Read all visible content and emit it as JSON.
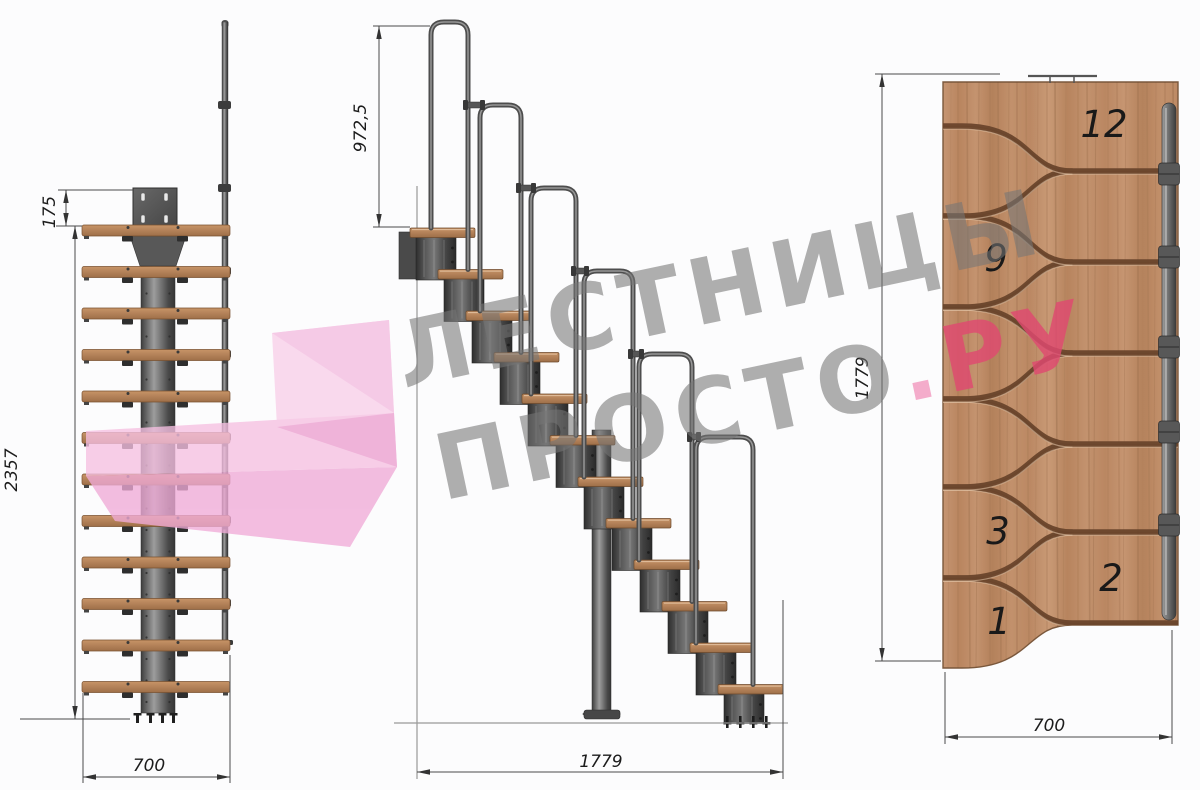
{
  "watermark": {
    "line1": "ЛЕСТНИЦЫ",
    "line2_word": "ПРОСТО",
    "line2_dot": ".",
    "line2_tld": "РУ"
  },
  "front_view": {
    "dim_top_offset": "175",
    "dim_total_height": "2357",
    "dim_width": "700"
  },
  "side_view": {
    "dim_handrail_height": "972,5",
    "dim_total_length": "1779"
  },
  "plan_view": {
    "dim_total_length": "1779",
    "dim_width": "700",
    "step_numbers": [
      "12",
      "9",
      "3",
      "2",
      "1"
    ]
  },
  "colors": {
    "watermark_gray": "#767676",
    "watermark_pink": "#df4970",
    "logo_pink_light": "#f8c9e6",
    "logo_pink_mid": "#f3b5dc",
    "logo_pink_dark": "#eb9fce",
    "wood_panel": "#c6946f",
    "tread_wood": "#b5845c",
    "metal_dark": "#3f3f3f",
    "metal_mid": "#6f6f6f"
  }
}
